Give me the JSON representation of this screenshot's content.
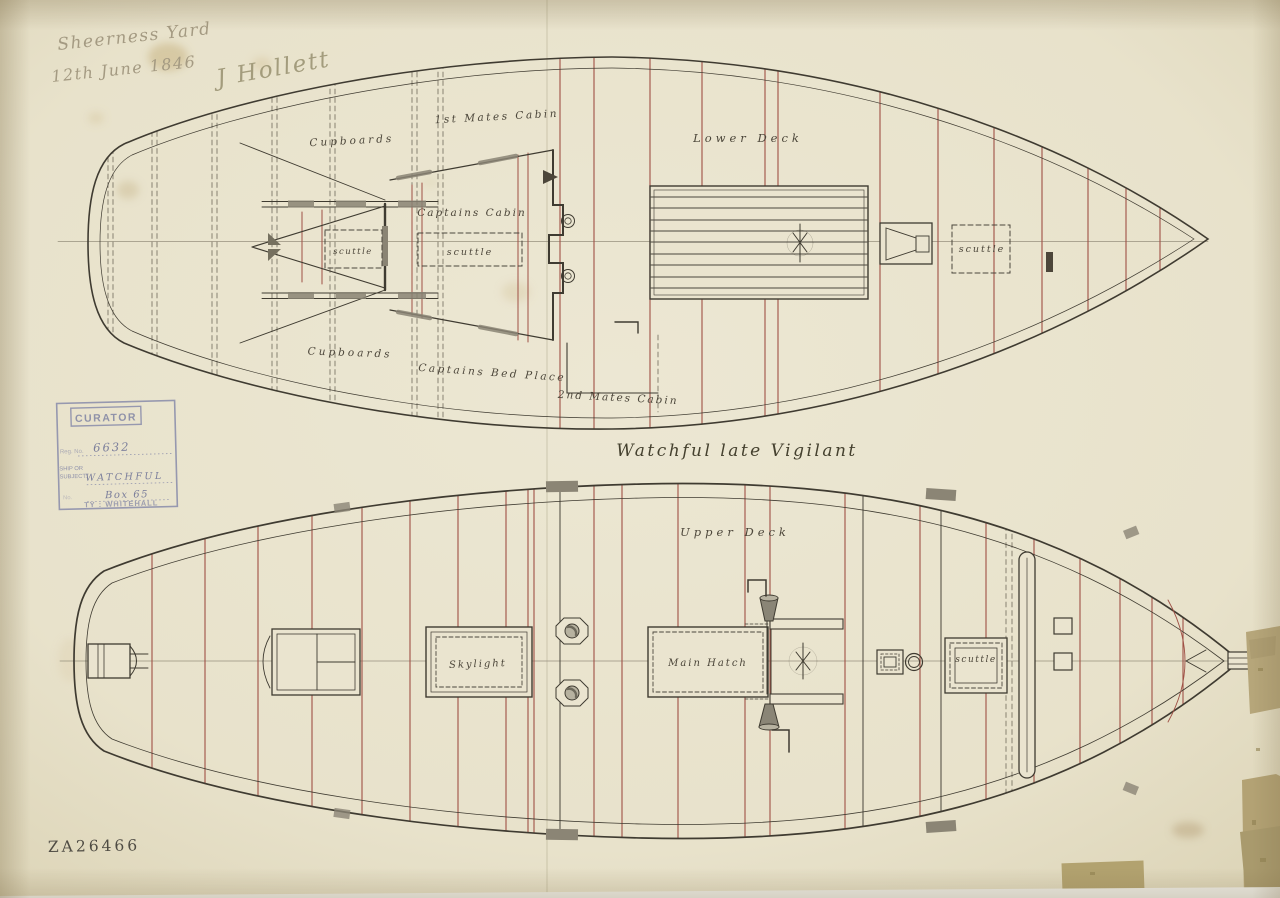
{
  "title": "Watchful late Vigilant",
  "inscription": {
    "line1": "Sheerness Yard",
    "line2": "12th June 1846",
    "signature": "J Hollett"
  },
  "stamp": {
    "header": "CURATOR",
    "reg_label": "Reg. No.",
    "reg_value": "6632",
    "subject_label_1": "SHIP OR",
    "subject_label_2": "SUBJECT:",
    "subject_value": "WATCHFUL",
    "box_label": "No.",
    "box_value": "Box 65",
    "authority": "TY : WHITEHALL"
  },
  "lower_deck": {
    "deck_name": "Lower Deck",
    "cupboards_top": "Cupboards",
    "first_mates_cabin": "1st Mates Cabin",
    "captains_cabin": "Captains Cabin",
    "captains_bed_place": "Captains Bed Place",
    "second_mates_cabin": "2nd Mates Cabin",
    "cupboards_bottom": "Cupboards",
    "scuttle_stern": "scuttle",
    "scuttle_cabin": "scuttle",
    "scuttle_forward": "scuttle"
  },
  "upper_deck": {
    "deck_name": "Upper Deck",
    "skylight": "Skylight",
    "main_hatch": "Main Hatch",
    "scuttle": "scuttle"
  },
  "archive_number": "ZA26466",
  "colors": {
    "paper": "#eae4cf",
    "ink": "#3f3b31",
    "beam_red": "#9f5045",
    "stamp_ink": "#8d90ac",
    "pencil": "#a49a82",
    "tape": "#b5a479"
  }
}
